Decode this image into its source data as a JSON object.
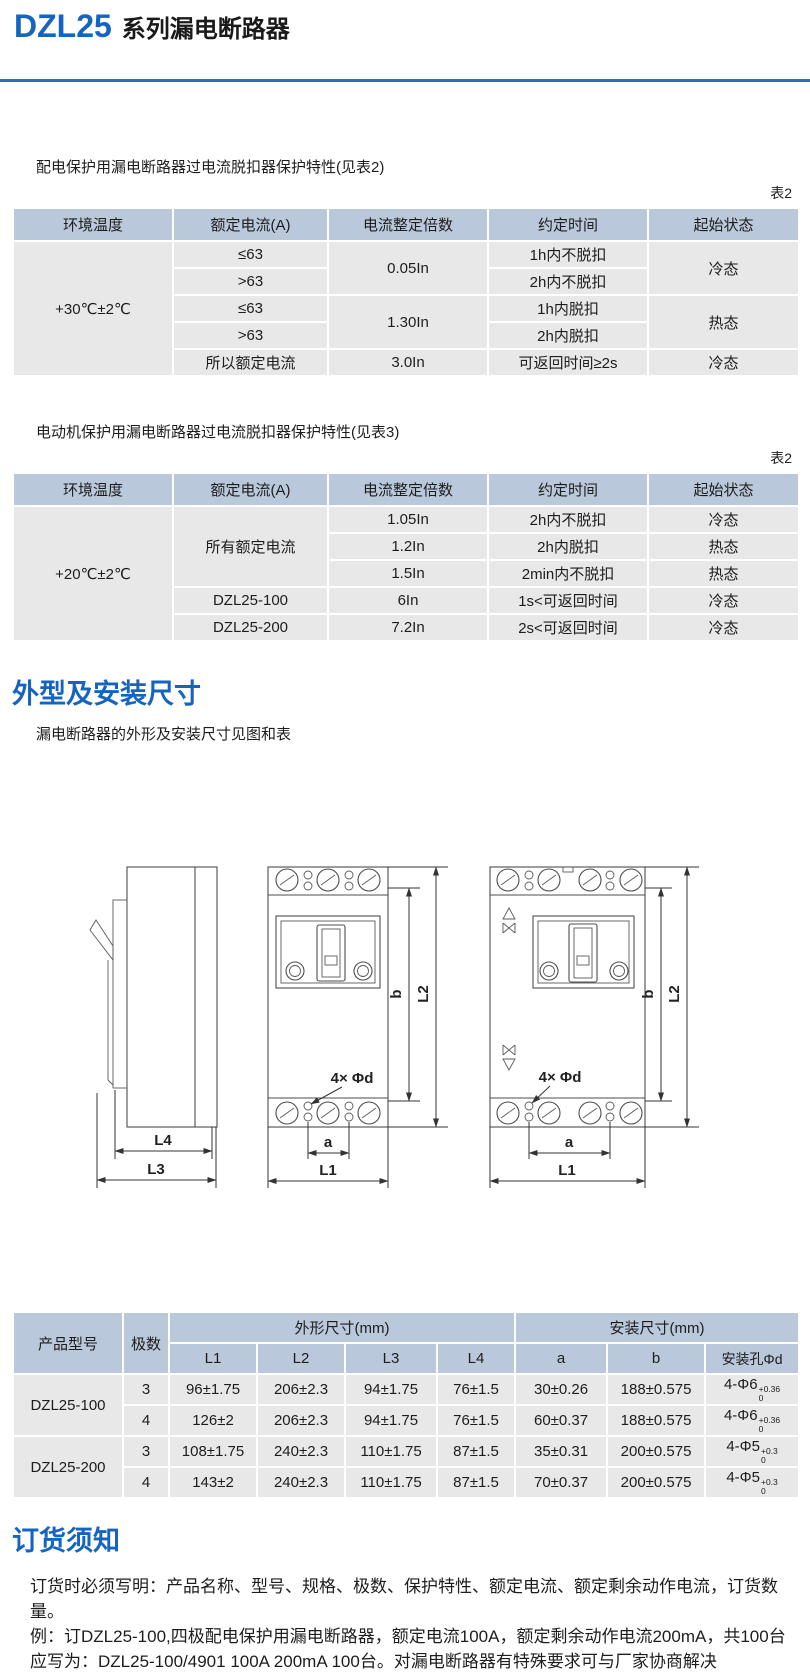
{
  "header": {
    "model": "DZL25",
    "series": "系列漏电断路器"
  },
  "colors": {
    "accent_blue": "#1565c0",
    "rule_blue": "#2273b8",
    "table_header_bg": "#b9c8da",
    "table_cell_bg": "#e8e8e8"
  },
  "table1": {
    "intro": "配电保护用漏电断路器过电流脱扣器保护特性(见表2)",
    "label": "表2",
    "headers": {
      "temp": "环境温度",
      "current": "额定电流(A)",
      "multiple": "电流整定倍数",
      "time": "约定时间",
      "state": "起始状态"
    },
    "ambient": "+30℃±2℃",
    "rows": {
      "r1": {
        "current": "≤63",
        "multiple": "0.05In",
        "time": "1h内不脱扣",
        "state": "冷态"
      },
      "r2": {
        "current": ">63",
        "time": "2h内不脱扣"
      },
      "r3": {
        "current": "≤63",
        "multiple": "1.30In",
        "time": "1h内脱扣",
        "state": "热态"
      },
      "r4": {
        "current": ">63",
        "time": "2h内脱扣"
      },
      "r5": {
        "current": "所以额定电流",
        "multiple": "3.0In",
        "time": "可返回时间≥2s",
        "state": "冷态"
      }
    }
  },
  "table2": {
    "intro": "电动机保护用漏电断路器过电流脱扣器保护特性(见表3)",
    "label": "表2",
    "headers": {
      "temp": "环境温度",
      "current": "额定电流(A)",
      "multiple": "电流整定倍数",
      "time": "约定时间",
      "state": "起始状态"
    },
    "ambient": "+20℃±2℃",
    "rows": {
      "r1": {
        "current": "所有额定电流",
        "multiple": "1.05In",
        "time": "2h内不脱扣",
        "state": "冷态"
      },
      "r2": {
        "multiple": "1.2In",
        "time": "2h内脱扣",
        "state": "热态"
      },
      "r3": {
        "multiple": "1.5In",
        "time": "2min内不脱扣",
        "state": "热态"
      },
      "r4": {
        "current": "DZL25-100",
        "multiple": "6In",
        "time": "1s<可返回时间",
        "state": "冷态"
      },
      "r5": {
        "current": "DZL25-200",
        "multiple": "7.2In",
        "time": "2s<可返回时间",
        "state": "冷态"
      }
    }
  },
  "outline": {
    "heading": "外型及安装尺寸",
    "note": "漏电断路器的外形及安装尺寸见图和表",
    "labels": {
      "L1": "L1",
      "L2": "L2",
      "L3": "L3",
      "L4": "L4",
      "a": "a",
      "b": "b",
      "holes": "4× Φd"
    }
  },
  "dim_table": {
    "header": {
      "product": "产品型号",
      "poles": "极数",
      "outline_group": "外形尺寸(mm)",
      "mount_group": "安装尺寸(mm)",
      "l1": "L1",
      "l2": "L2",
      "l3": "L3",
      "l4": "L4",
      "a": "a",
      "b": "b",
      "hole": "安装孔Φd"
    },
    "groups": [
      {
        "model": "DZL25-100",
        "rows": [
          {
            "poles": "3",
            "L1": "96±1.75",
            "L2": "206±2.3",
            "L3": "94±1.75",
            "L4": "76±1.5",
            "a": "30±0.26",
            "b": "188±0.575",
            "d": "4-Φ6",
            "sup": "+0.36",
            "sub": "0"
          },
          {
            "poles": "4",
            "L1": "126±2",
            "L2": "206±2.3",
            "L3": "94±1.75",
            "L4": "76±1.5",
            "a": "60±0.37",
            "b": "188±0.575",
            "d": "4-Φ6",
            "sup": "+0.36",
            "sub": "0"
          }
        ]
      },
      {
        "model": "DZL25-200",
        "rows": [
          {
            "poles": "3",
            "L1": "108±1.75",
            "L2": "240±2.3",
            "L3": "110±1.75",
            "L4": "87±1.5",
            "a": "35±0.31",
            "b": "200±0.575",
            "d": "4-Φ5",
            "sup": "+0.3",
            "sub": "0"
          },
          {
            "poles": "4",
            "L1": "143±2",
            "L2": "240±2.3",
            "L3": "110±1.75",
            "L4": "87±1.5",
            "a": "70±0.37",
            "b": "200±0.575",
            "d": "4-Φ5",
            "sup": "+0.3",
            "sub": "0"
          }
        ]
      }
    ]
  },
  "ordering": {
    "heading": "订货须知",
    "lines": [
      "订货时必须写明：产品名称、型号、规格、极数、保护特性、额定电流、额定剩余动作电流，订货数",
      "量。",
      "例：订DZL25-100,四极配电保护用漏电断路器，额定电流100A，额定剩余动作电流200mA，共100台",
      "应写为：DZL25-100/4901 100A 200mA 100台。对漏电断路器有特殊要求可与厂家协商解决"
    ]
  }
}
